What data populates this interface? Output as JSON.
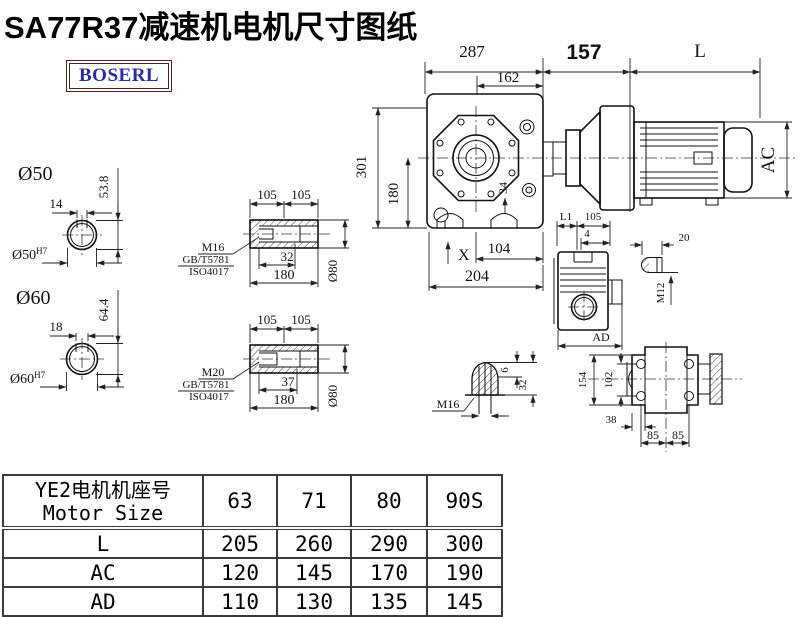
{
  "title": "SA77R37减速机电机尺寸图纸",
  "logo": {
    "text": "BOSERL"
  },
  "colors": {
    "line": "#111111",
    "logo_text": "#2a2ab0",
    "logo_border": "#4a2323",
    "table_border": "#3a3a3a"
  },
  "drawing": {
    "top_dims": {
      "d287": "287",
      "d162": "162",
      "d157": "157",
      "dL": "L"
    },
    "front_view": {
      "d301": "301",
      "d180": "180",
      "d34": "34",
      "dX": "X",
      "d104": "104",
      "d204": "204"
    },
    "motor_view": {
      "dAC": "AC"
    },
    "shaft50": {
      "label": "Ø50",
      "d14": "14",
      "d53_8": "53.8",
      "bore": "Ø50",
      "tol": "H7"
    },
    "shaft60": {
      "label": "Ø60",
      "d18": "18",
      "d64_4": "64.4",
      "bore": "Ø60",
      "tol": "H7"
    },
    "hub1": {
      "d105a": "105",
      "d105b": "105",
      "bolt": "M16",
      "std": "GB/T5781",
      "iso": "ISO4017",
      "d32": "32",
      "d180": "180",
      "dia": "Ø80"
    },
    "hub2": {
      "d105a": "105",
      "d105b": "105",
      "bolt": "M20",
      "std": "GB/T5781",
      "iso": "ISO4017",
      "d37": "37",
      "d180": "180",
      "dia": "Ø80"
    },
    "rear_view": {
      "dL1": "L1",
      "d105": "105",
      "d4": "4",
      "dAD": "AD"
    },
    "pin": {
      "d20": "20",
      "m12": "M12"
    },
    "plug": {
      "d6": "6",
      "d32": "32",
      "m16": "M16"
    },
    "top_view": {
      "d154": "154",
      "d102": "102",
      "d38": "38",
      "d85a": "85",
      "d85b": "85"
    }
  },
  "table": {
    "header_cn": "YE2电机机座号",
    "header_en": "Motor Size",
    "sizes": [
      "63",
      "71",
      "80",
      "90S"
    ],
    "rows": [
      {
        "label": "L",
        "values": [
          "205",
          "260",
          "290",
          "300"
        ]
      },
      {
        "label": "AC",
        "values": [
          "120",
          "145",
          "170",
          "190"
        ]
      },
      {
        "label": "AD",
        "values": [
          "110",
          "130",
          "135",
          "145"
        ]
      }
    ]
  }
}
